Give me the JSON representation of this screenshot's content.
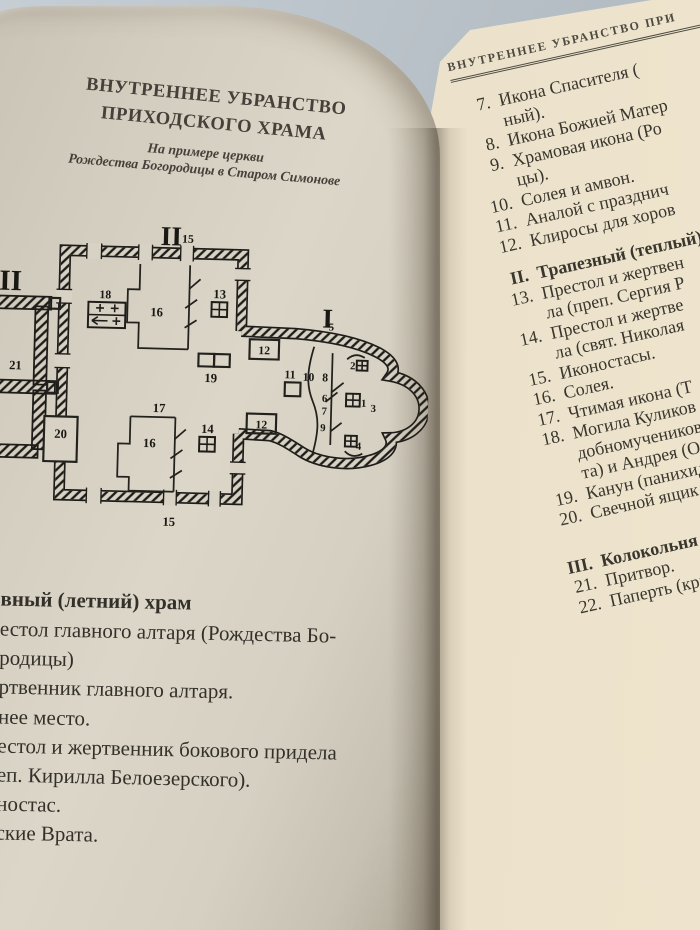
{
  "colors": {
    "background": "#b7bfc6",
    "paper_left": "#d8d2c4",
    "paper_right": "#e7ddc6",
    "ink": "#35322b"
  },
  "left_page": {
    "title_line1": "ВНУТРЕННЕЕ УБРАНСТВО",
    "title_line2": "ПРИХОДСКОГО ХРАМА",
    "subtitle_line1": "На примере церкви",
    "subtitle_line2": "Рождества Богородицы в Старом Симонове",
    "section_heading": "вный (летний) храм",
    "list_lines": [
      "естол главного алтаря (Рождества Бо-",
      "родицы)",
      "ртвенник главного алтаря.",
      "нее место.",
      "естол и жертвенник бокового придела",
      "еп. Кирилла Белоезерского).",
      "ностас.",
      "ские Врата."
    ],
    "diagram": {
      "labels": [
        {
          "t": "II",
          "x": 183,
          "y": 40,
          "s": 28
        },
        {
          "t": "III",
          "x": 14,
          "y": 90,
          "s": 30
        },
        {
          "t": "I",
          "x": 345,
          "y": 120,
          "s": 28
        },
        {
          "t": "15",
          "x": 200,
          "y": 37,
          "s": 12
        },
        {
          "t": "15",
          "x": 188,
          "y": 327,
          "s": 13
        },
        {
          "t": "18",
          "x": 117,
          "y": 96,
          "s": 12
        },
        {
          "t": "16",
          "x": 170,
          "y": 113,
          "s": 13
        },
        {
          "t": "13",
          "x": 234,
          "y": 93,
          "s": 13
        },
        {
          "t": "12",
          "x": 281,
          "y": 149,
          "s": 12
        },
        {
          "t": "12",
          "x": 280,
          "y": 225,
          "s": 12
        },
        {
          "t": "19",
          "x": 227,
          "y": 179,
          "s": 13
        },
        {
          "t": "5",
          "x": 349,
          "y": 123,
          "s": 11
        },
        {
          "t": "11",
          "x": 308,
          "y": 173,
          "s": 12
        },
        {
          "t": "10",
          "x": 327,
          "y": 175,
          "s": 12
        },
        {
          "t": "8",
          "x": 344,
          "y": 175,
          "s": 12
        },
        {
          "t": "2",
          "x": 372,
          "y": 162,
          "s": 11
        },
        {
          "t": "6",
          "x": 344,
          "y": 196,
          "s": 11
        },
        {
          "t": "7",
          "x": 344,
          "y": 209,
          "s": 11
        },
        {
          "t": "9",
          "x": 343,
          "y": 226,
          "s": 11
        },
        {
          "t": "1",
          "x": 384,
          "y": 200,
          "s": 11
        },
        {
          "t": "3",
          "x": 394,
          "y": 205,
          "s": 11
        },
        {
          "t": "4",
          "x": 380,
          "y": 244,
          "s": 11
        },
        {
          "t": "21",
          "x": 27,
          "y": 171,
          "s": 13
        },
        {
          "t": "20",
          "x": 75,
          "y": 240,
          "s": 13
        },
        {
          "t": "17",
          "x": 175,
          "y": 211,
          "s": 13
        },
        {
          "t": "14",
          "x": 225,
          "y": 231,
          "s": 13
        },
        {
          "t": "16",
          "x": 166,
          "y": 247,
          "s": 13
        }
      ]
    }
  },
  "right_page": {
    "running_head": "ВНУТРЕННЕЕ УБРАНСТВО ПРИ",
    "items": [
      {
        "num": "7.",
        "lines": [
          "Икона Спасителя (",
          "ный)."
        ]
      },
      {
        "num": "8.",
        "lines": [
          "Икона Божией Матер"
        ]
      },
      {
        "num": "9.",
        "lines": [
          "Храмовая икона (Ро",
          "цы)."
        ]
      },
      {
        "num": "10.",
        "lines": [
          "Солея и амвон."
        ]
      },
      {
        "num": "11.",
        "lines": [
          "Аналой с празднич"
        ]
      },
      {
        "num": "12.",
        "lines": [
          "Клиросы для хоров"
        ]
      },
      {
        "num": "II.",
        "lines": [
          "Трапезный (теплый)"
        ],
        "bold": true
      },
      {
        "num": "13.",
        "lines": [
          "Престол и жертвен",
          "ла (преп. Сергия Р"
        ]
      },
      {
        "num": "14.",
        "lines": [
          "Престол и жертве",
          "ла (свят. Николая"
        ]
      },
      {
        "num": "15.",
        "lines": [
          "Иконостасы."
        ]
      },
      {
        "num": "16.",
        "lines": [
          "Солея."
        ]
      },
      {
        "num": "17.",
        "lines": [
          "Чтимая икона (Т"
        ]
      },
      {
        "num": "18.",
        "lines": [
          "Могила Куликов",
          "добномучеников",
          "та) и Андрея (Ос"
        ]
      },
      {
        "num": "19.",
        "lines": [
          "Канун (панихид"
        ]
      },
      {
        "num": "20.",
        "lines": [
          "Свечной ящик."
        ]
      },
      {
        "num": "III.",
        "lines": [
          "Колокольня (раз"
        ],
        "bold": true,
        "big_gap": true
      },
      {
        "num": "21.",
        "lines": [
          "Притвор."
        ]
      },
      {
        "num": "22.",
        "lines": [
          "Паперть (крыль"
        ]
      }
    ]
  }
}
